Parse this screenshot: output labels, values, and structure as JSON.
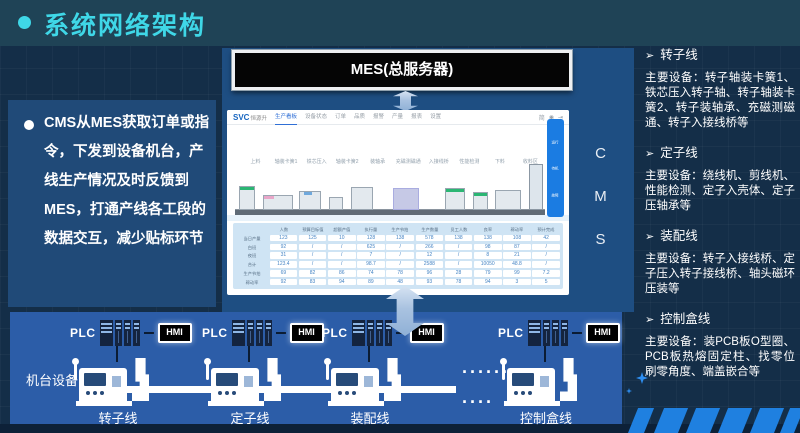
{
  "header": {
    "title": "系统网络架构"
  },
  "intro": {
    "text": "CMS从MES获取订单或指令，下发到设备机台，产线生产情况及时反馈到MES，打通产线各工段的数据交互，减少贴标环节"
  },
  "mes": {
    "label": "MES(总服务器)"
  },
  "cms": {
    "letters": [
      "C",
      "M",
      "S"
    ]
  },
  "app": {
    "logo": "SVC",
    "logo_sub": "恒源升",
    "nav": [
      "生产看板",
      "设备状态",
      "订单",
      "品质",
      "报警",
      "产量",
      "报表",
      "设置"
    ],
    "toolbar": {
      "lang": "简",
      "user_icon": "◉",
      "logout_icon": "⇥"
    },
    "status_colors": {
      "run": "#2cc32c",
      "idle": "#c8ced4"
    },
    "stations": [
      {
        "state": "idle",
        "label": "上料"
      },
      {
        "state": "run",
        "label": "轴装卡簧1"
      },
      {
        "state": "run",
        "label": "铁芯压入"
      },
      {
        "state": "run",
        "label": "轴装卡簧2"
      },
      {
        "state": "run",
        "label": "装轴承"
      },
      {
        "state": "idle",
        "label": "充磁测磁通"
      },
      {
        "state": "run",
        "label": "入接线桥"
      },
      {
        "state": "run",
        "label": "性能检测"
      },
      {
        "state": "run",
        "label": "下料"
      },
      {
        "state": "run",
        "label": "收料区"
      }
    ],
    "legend": [
      {
        "label": "运行",
        "color": "#2cc32c"
      },
      {
        "label": "待机",
        "color": "#f2c51d"
      },
      {
        "label": "故障",
        "color": "#e13431"
      }
    ],
    "table": {
      "col_headers": [
        "",
        "人数",
        "预算目标值",
        "超额产值",
        "执行量",
        "生产节拍",
        "生产数量",
        "员工人数",
        "良率",
        "稼动率",
        "预计完成"
      ],
      "rows": [
        {
          "label": "当日产量",
          "cells": [
            "123",
            "125",
            "10",
            "128",
            "138",
            "578",
            "138",
            "138",
            "108",
            "42"
          ]
        },
        {
          "label": "白班",
          "cells": [
            "92",
            "/",
            "/",
            "625",
            "/",
            "266",
            "/",
            "98",
            "87",
            "/"
          ]
        },
        {
          "label": "夜班",
          "cells": [
            "31",
            "/",
            "/",
            "7",
            "/",
            "12",
            "/",
            "8",
            "21",
            "/"
          ]
        },
        {
          "label": "合计",
          "cells": [
            "123.4",
            "/",
            "/",
            "98.7",
            "/",
            "2588",
            "/",
            "10050",
            "48.8",
            "/"
          ]
        },
        {
          "label": "生产节拍",
          "cells": [
            "69",
            "82",
            "86",
            "74",
            "78",
            "96",
            "28",
            "79",
            "99",
            "7.2"
          ]
        },
        {
          "label": "稼动率",
          "cells": [
            "92",
            "83",
            "94",
            "89",
            "48",
            "93",
            "78",
            "94",
            "3",
            "5"
          ]
        }
      ]
    }
  },
  "floor": {
    "caption": "机台设备：",
    "dots1": "······",
    "dots2": "····",
    "groups": [
      {
        "plc": "PLC",
        "hmi": "HMI",
        "line": "转子线"
      },
      {
        "plc": "PLC",
        "hmi": "HMI",
        "line": "定子线"
      },
      {
        "plc": "PLC",
        "hmi": "HMI",
        "line": "装配线"
      },
      {
        "plc": "PLC",
        "hmi": "HMI",
        "line": "控制盒线"
      }
    ]
  },
  "lines": {
    "marker": "➢",
    "sections": [
      {
        "heading": "转子线",
        "body": "主要设备：转子轴装卡簧1、铁芯压入转子轴、转子轴装卡簧2、转子装轴承、充磁测磁通、转子入接线桥等"
      },
      {
        "heading": "定子线",
        "body": "主要设备：绕线机、剪线机、性能检测、定子入壳体、定子压轴承等"
      },
      {
        "heading": "装配线",
        "body": "主要设备：转子入接线桥、定子压入转子接线桥、轴头磁环压装等"
      },
      {
        "heading": "控制盒线",
        "body": "主要设备：装PCB板O型圈、PCB板热熔固定柱、找零位刷零角度、端盖嵌合等"
      }
    ]
  }
}
